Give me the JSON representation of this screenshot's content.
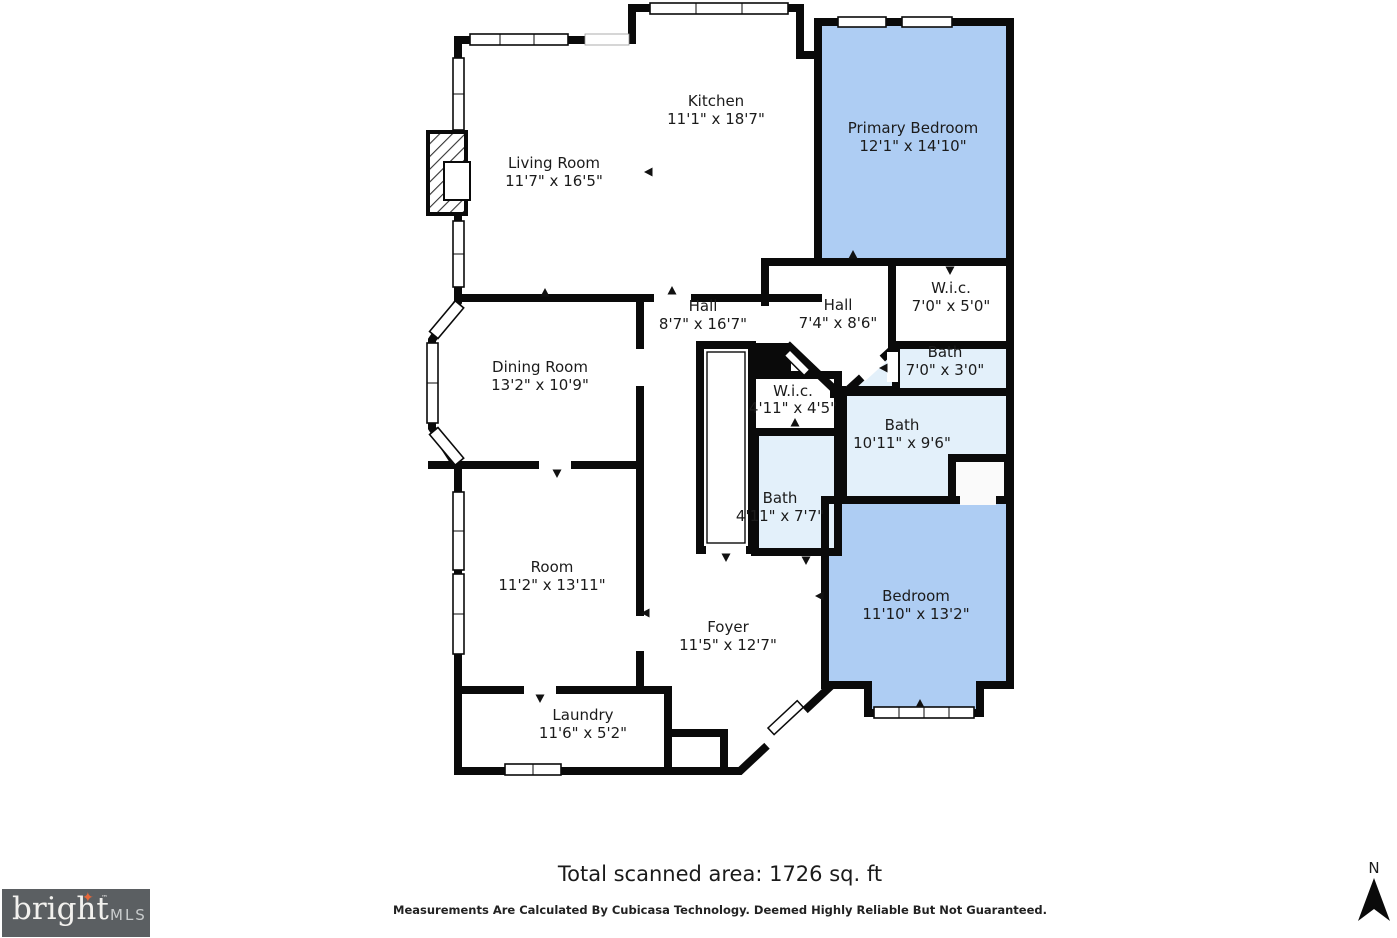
{
  "colors": {
    "bedroom_fill": "#aecdf3",
    "bath_fill": "#e3f0fa",
    "room_fill": "#ffffff",
    "wall": "#0a0a0a",
    "logo_bg": "#5b5f62",
    "logo_accent": "#e8683a"
  },
  "rooms": [
    {
      "name": "Kitchen",
      "dims": "11'1\" x 18'7\""
    },
    {
      "name": "Living Room",
      "dims": "11'7\" x 16'5\""
    },
    {
      "name": "Primary Bedroom",
      "dims": "12'1\" x 14'10\""
    },
    {
      "name": "Hall",
      "dims": "8'7\" x 16'7\""
    },
    {
      "name": "Hall",
      "dims": "7'4\" x 8'6\""
    },
    {
      "name": "W.i.c.",
      "dims": "7'0\" x 5'0\""
    },
    {
      "name": "Bath",
      "dims": "7'0\" x 3'0\""
    },
    {
      "name": "Bath",
      "dims": "10'11\" x 9'6\""
    },
    {
      "name": "W.i.c.",
      "dims": "4'11\" x 4'5\""
    },
    {
      "name": "Bath",
      "dims": "4'11\" x 7'7\""
    },
    {
      "name": "Bedroom",
      "dims": "11'10\" x 13'2\""
    },
    {
      "name": "Dining Room",
      "dims": "13'2\" x 10'9\""
    },
    {
      "name": "Room",
      "dims": "11'2\" x 13'11\""
    },
    {
      "name": "Foyer",
      "dims": "11'5\" x 12'7\""
    },
    {
      "name": "Laundry",
      "dims": "11'6\" x 5'2\""
    }
  ],
  "footer": {
    "total_area": "Total scanned area: 1726 sq. ft",
    "disclaimer": "Measurements Are Calculated By Cubicasa Technology. Deemed Highly Reliable But Not Guaranteed."
  },
  "logo": {
    "brand": "bright",
    "tm": "™",
    "suffix": "MLS",
    "arrow": "✦"
  },
  "compass": {
    "label": "N"
  }
}
